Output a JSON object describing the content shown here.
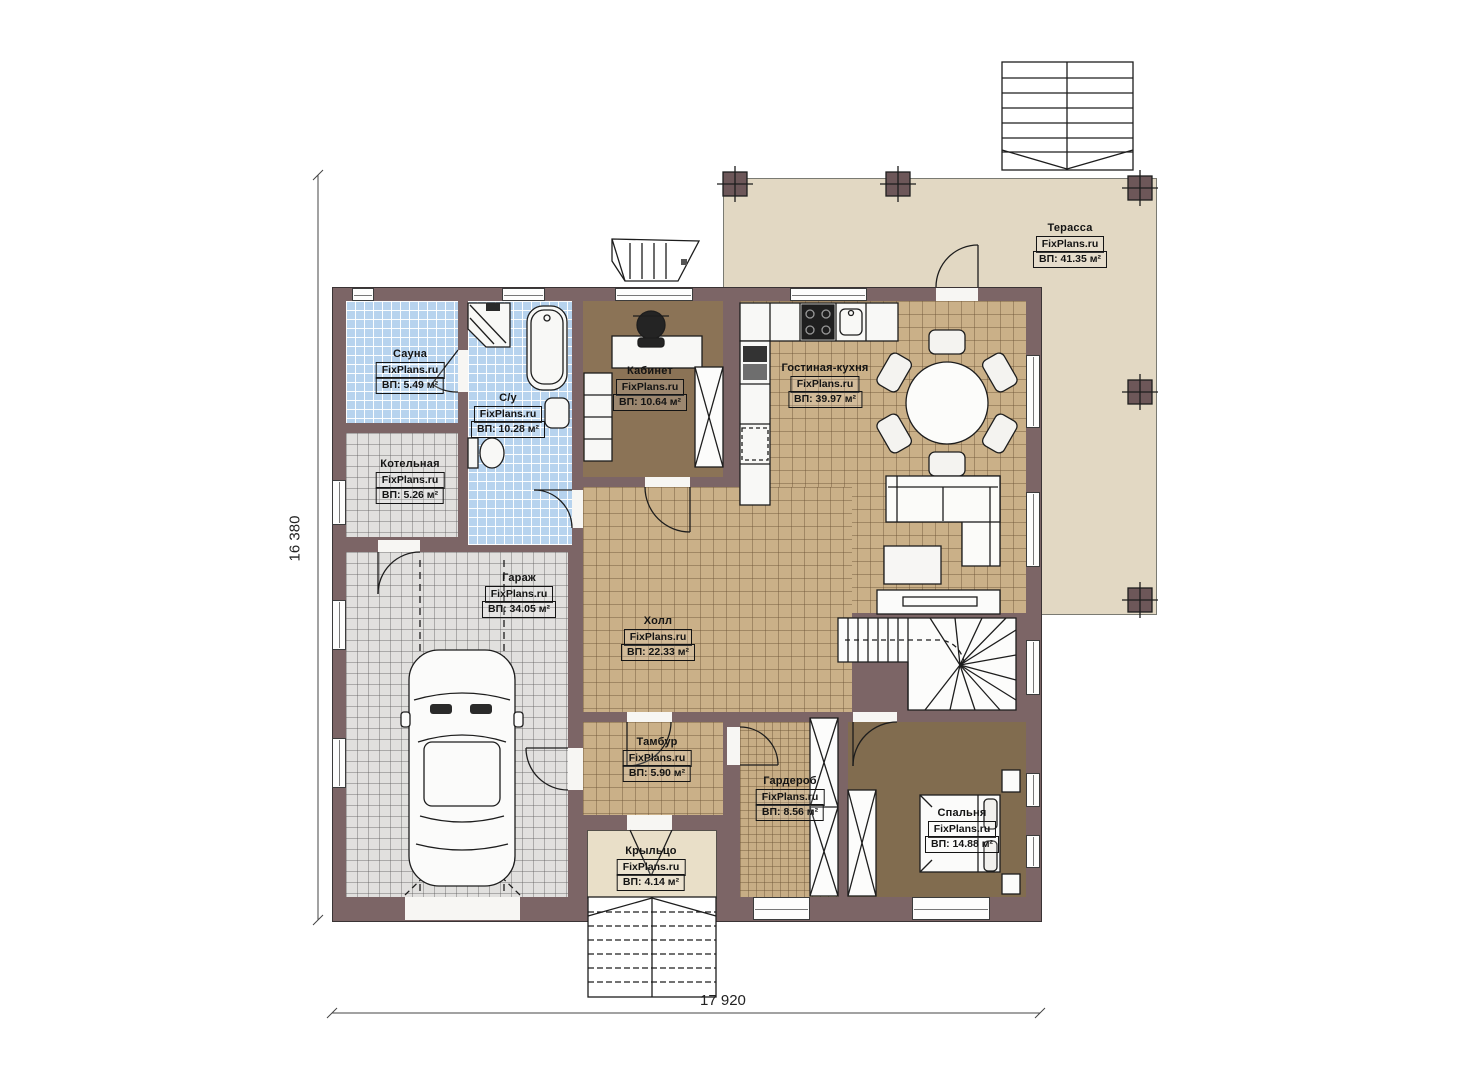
{
  "watermark": "FixPlans.ru",
  "dimensions": {
    "width_label": "17 920",
    "height_label": "16 380"
  },
  "rooms": [
    {
      "name": "Сауна",
      "area": "ВП: 5.49 м²"
    },
    {
      "name": "С/у",
      "area": "ВП: 10.28 м²"
    },
    {
      "name": "Котельная",
      "area": "ВП: 5.26 м²"
    },
    {
      "name": "Гараж",
      "area": "ВП: 34.05 м²"
    },
    {
      "name": "Кабинет",
      "area": "ВП: 10.64 м²"
    },
    {
      "name": "Гостиная-кухня",
      "area": "ВП: 39.97 м²"
    },
    {
      "name": "Холл",
      "area": "ВП: 22.33 м²"
    },
    {
      "name": "Тамбур",
      "area": "ВП: 5.90 м²"
    },
    {
      "name": "Гардероб",
      "area": "ВП: 8.56 м²"
    },
    {
      "name": "Спальня",
      "area": "ВП: 14.88 м²"
    },
    {
      "name": "Крыльцо",
      "area": "ВП: 4.14 м²"
    },
    {
      "name": "Терасса",
      "area": "ВП: 41.35 м²"
    }
  ],
  "colors": {
    "wall": "#7c6566",
    "blue_tile": "#b7d3ee",
    "gray_tile": "#e1e0de",
    "tan_tile": "#cab088",
    "wood_floor": "#8b7356",
    "terrace": "#e2d8c3",
    "porch": "#e9dfc8"
  }
}
